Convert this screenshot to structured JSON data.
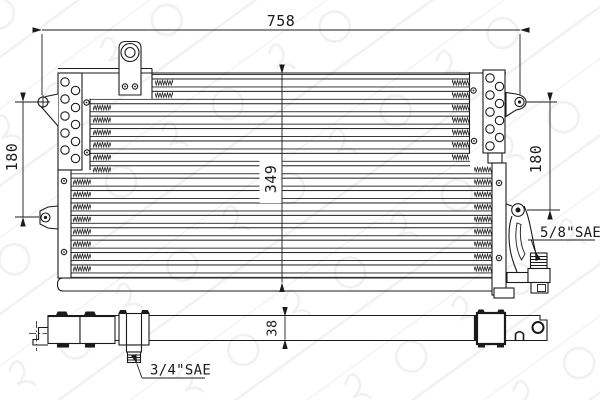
{
  "drawing_labels": {
    "dim_width_top": "758",
    "dim_height_left": "180",
    "dim_height_core": "349",
    "dim_height_right": "180",
    "dim_depth_bottom": "38",
    "fitting_right": "5/8\"SAE",
    "fitting_bottom": "3/4\"SAE"
  },
  "colors": {
    "line": "#1b1b1b",
    "background": "#ffffff",
    "watermark": "#5a5a5a"
  }
}
